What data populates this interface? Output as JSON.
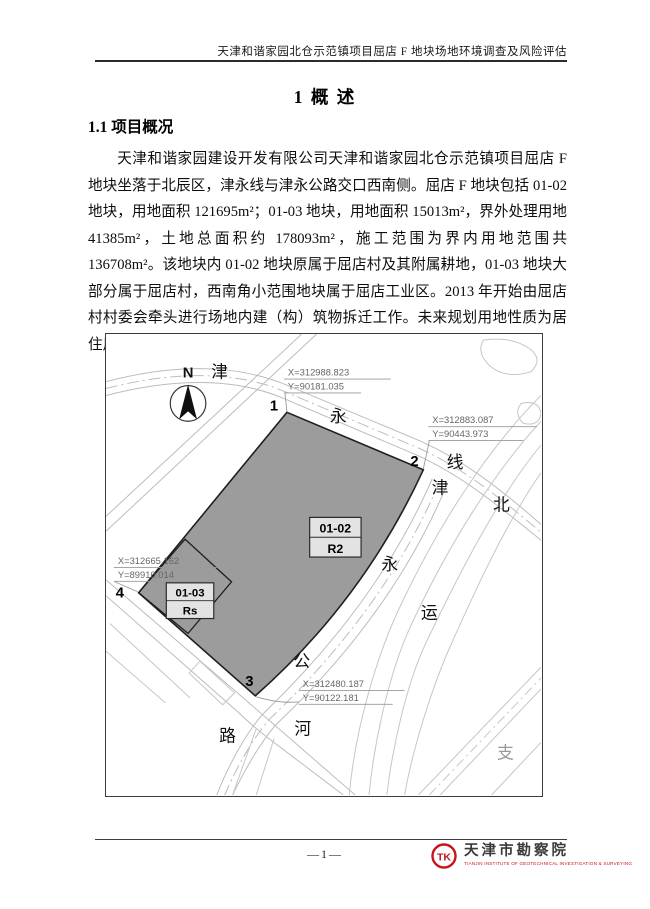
{
  "header": {
    "title": "天津和谐家园北仓示范镇项目屈店 F 地块场地环境调查及风险评估"
  },
  "overview": {
    "chapter_title": "1 概 述",
    "section_title": "1.1 项目概况",
    "paragraph": "天津和谐家园建设开发有限公司天津和谐家园北仓示范镇项目屈店 F 地块坐落于北辰区，津永线与津永公路交口西南侧。屈店 F 地块包括 01-02 地块，用地面积 121695m²；01-03 地块，用地面积 15013m²，界外处理用地 41385m²，土地总面积约 178093m²，施工范围为界内用地范围共 136708m²。该地块内 01-02 地块原属于屈店村及其附属耕地，01-03 地块大部分属于屈店村，西南角小范围地块属于屈店工业区。2013 年开始由屈店村村委会牵头进行场地内建（构）筑物拆迁工作。未来规划用地性质为居住用地和中小学、幼儿园用地。"
  },
  "map": {
    "north_label": "N",
    "points": [
      {
        "num": "1",
        "x_label": "X=312988.823",
        "y_label": "Y=90181.035"
      },
      {
        "num": "2",
        "x_label": "X=312883.087",
        "y_label": "Y=90443.973"
      },
      {
        "num": "3",
        "x_label": "X=312480.187",
        "y_label": "Y=90122.181"
      },
      {
        "num": "4",
        "x_label": "X=312665.162",
        "y_label": "Y=89910.014"
      }
    ],
    "parcels": [
      {
        "code": "01-02",
        "zone": "R2"
      },
      {
        "code": "01-03",
        "zone": "Rs"
      }
    ],
    "roads": [
      {
        "name": "津永线",
        "chars": [
          "津",
          "永",
          "线"
        ]
      },
      {
        "name": "津永公路",
        "chars": [
          "津",
          "永",
          "公",
          "路"
        ]
      },
      {
        "name": "北运河",
        "chars": [
          "北",
          "运",
          "河"
        ]
      },
      {
        "name": "支",
        "chars": [
          "支"
        ]
      }
    ],
    "colors": {
      "parcel_fill": "#9c9c9c"
    }
  },
  "footer": {
    "page_number": "—1—",
    "logo": {
      "monogram": "TK",
      "name": "天津市勘察院",
      "caption": "TIANJIN INSTITUTE OF GEOTECHNICAL INVESTIGATION & SURVEYING",
      "color": "#c4161c"
    }
  }
}
